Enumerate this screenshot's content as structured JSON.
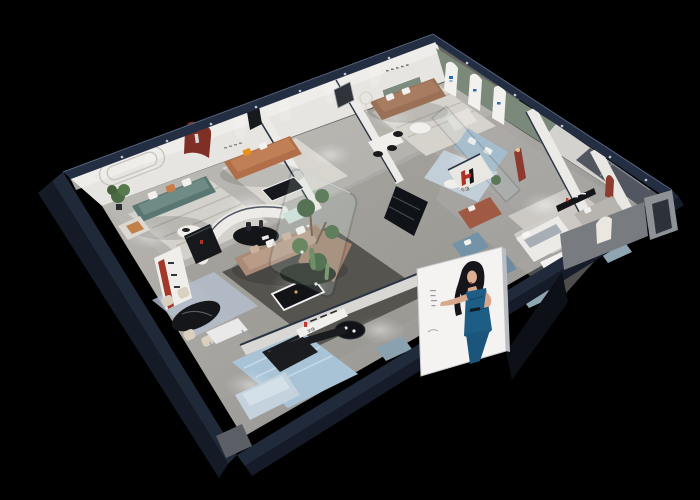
{
  "scene": {
    "description": "Night-time isometric 3D cutaway render of a furniture brand showroom",
    "background_color": "#000000",
    "shell_rim_color": "#222e42",
    "wall_color": "#e8e6e2",
    "floor_color": "#a3a19d",
    "green_feature_wall": "#7b897b",
    "brand": {
      "logo_text": "华饶",
      "logo_red": "#b03226",
      "logo_black": "#141414"
    },
    "rooms": [
      {
        "id": "lounge-teal",
        "label": "teal sofa lounge",
        "furniture": [
          "teal three-seat sofa",
          "white armchair with orange cushion",
          "round white coffee table",
          "potted plant",
          "striped grey rug",
          "curved wall moulding"
        ]
      },
      {
        "id": "lounge-orange",
        "label": "orange leather lounge",
        "furniture": [
          "tan leather sofa",
          "orange accent pillows",
          "black coffee table",
          "oxblood arched niche with sculpture",
          "white desk",
          "black chairs"
        ]
      },
      {
        "id": "lounge-brown",
        "label": "brown leather lounge",
        "furniture": [
          "brown leather sofa",
          "white armchair",
          "round coffee table",
          "floor lamp",
          "green wall with three white arched panels"
        ]
      },
      {
        "id": "lounge-glass",
        "label": "glass-walled blue lounge",
        "furniture": [
          "powder-blue sofa",
          "white side table",
          "potted plant",
          "blue rug"
        ]
      },
      {
        "id": "bedroom",
        "label": "bedroom vignette",
        "furniture": [
          "white upholstered bed",
          "grey sofa",
          "black wall shelf with brand mark",
          "oxblood narrow arch niche"
        ]
      },
      {
        "id": "lounge-east",
        "label": "east corner white lounge",
        "furniture": [
          "white sofa",
          "black side table"
        ]
      },
      {
        "id": "showroom-center",
        "label": "central showroom",
        "furniture": [
          "beige L-shaped sectional",
          "black and white coffee table",
          "charcoal rug",
          "curved white partition",
          "black oval display table with vases",
          "glass planter box with cacti",
          "black media bench",
          "terracotta sofa under brand monogram",
          "blue armchairs",
          "black pedestal table",
          "steel-blue ottomans"
        ]
      },
      {
        "id": "dining",
        "label": "dining vignette",
        "furniture": [
          "black oval marble table",
          "four cream chairs",
          "tall display cabinet with red trim",
          "black sideboard"
        ]
      },
      {
        "id": "entry",
        "label": "front gallery",
        "furniture": [
          "patterned blue rug",
          "chrome-leg white bench",
          "black gloss bench",
          "powder-blue sofa",
          "white sign ledge"
        ]
      }
    ],
    "signage": [
      {
        "id": "wall-monogram",
        "text": "华饶",
        "style": "red and black H monogram on white partition"
      },
      {
        "id": "front-ledge-sign",
        "text": "华饶",
        "style": "red mark with dark lettering on white ledge"
      },
      {
        "id": "arch-panels",
        "text": "",
        "style": "three white arched panels with small blue marks"
      }
    ],
    "poster": {
      "subject": "woman in a teal-blue evening dress, hand on hip",
      "panel_color": "#f4f3f1",
      "dress_color": "#1e5d85",
      "location": "lightbox on the front-right facade"
    },
    "lighting": {
      "style": "recessed ceiling spotlights",
      "effect": "white light pools on floors"
    }
  }
}
